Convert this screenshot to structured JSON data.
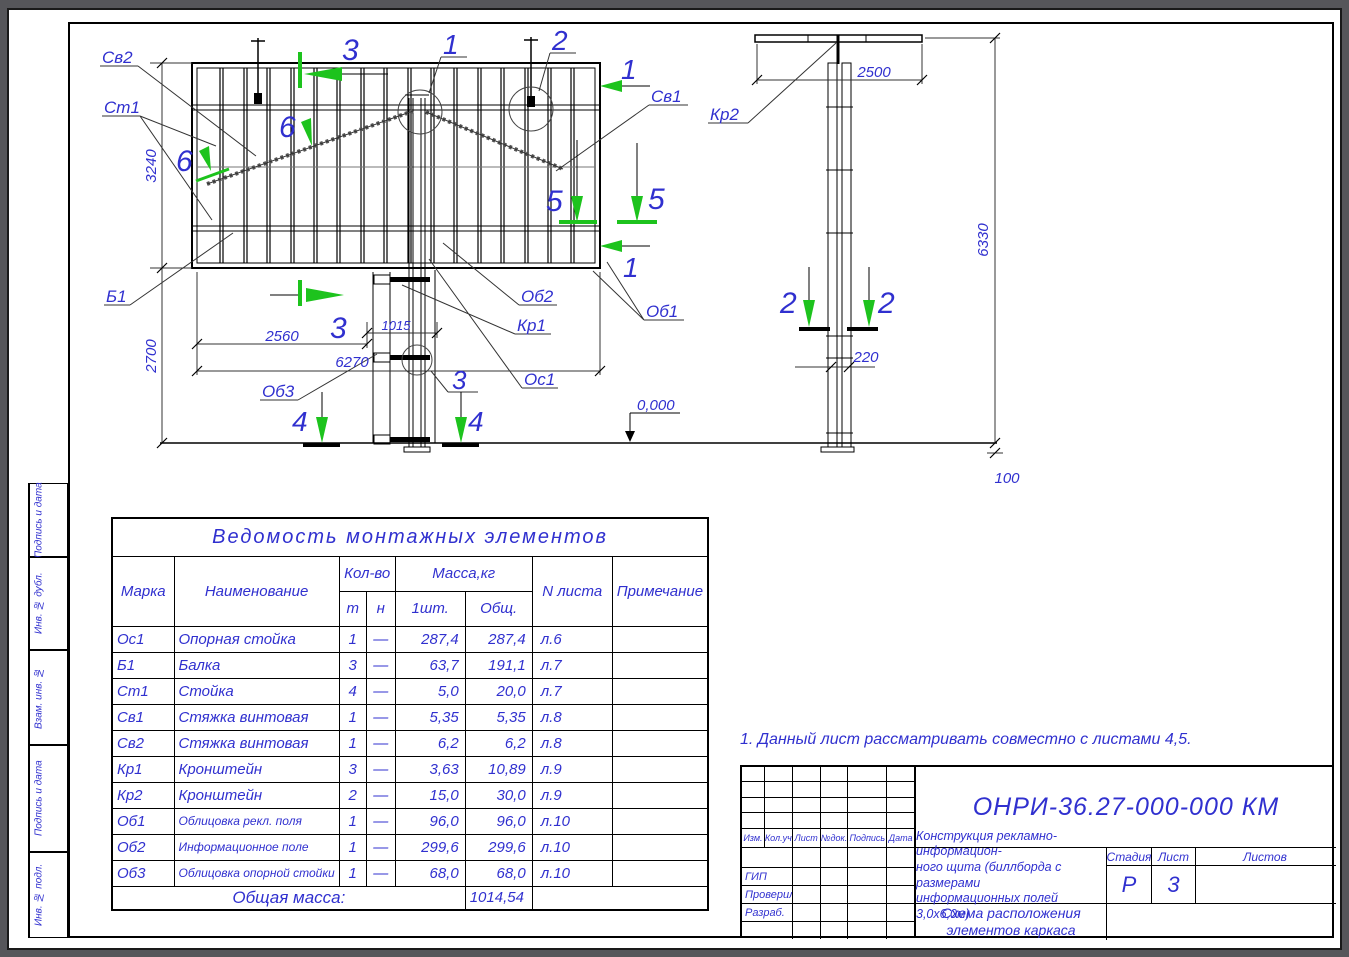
{
  "colors": {
    "blue": "#3030cf",
    "green": "#1dc31d",
    "line": "#000000",
    "background": "#56565a"
  },
  "sidebar": {
    "cells": [
      "Подпись и дата",
      "Инв. № дубл.",
      "Взам. инв. №",
      "Подпись и дата",
      "Инв. № подл."
    ]
  },
  "table": {
    "title": "Ведомость монтажных элементов",
    "col_mark": "Марка",
    "col_name": "Наименование",
    "col_qty": "Кол-во",
    "col_t": "т",
    "col_n": "н",
    "col_mass": "Масса,кг",
    "col_one": "1шт.",
    "col_total": "Общ.",
    "col_sheet": "N листа",
    "col_note": "Примечание",
    "rows": [
      {
        "mark": "Ос1",
        "name": "Опорная стойка",
        "t": "1",
        "n": "—",
        "one": "287,4",
        "total": "287,4",
        "sheet": "л.6",
        "note": ""
      },
      {
        "mark": "Б1",
        "name": "Балка",
        "t": "3",
        "n": "—",
        "one": "63,7",
        "total": "191,1",
        "sheet": "л.7",
        "note": ""
      },
      {
        "mark": "Ст1",
        "name": "Стойка",
        "t": "4",
        "n": "—",
        "one": "5,0",
        "total": "20,0",
        "sheet": "л.7",
        "note": ""
      },
      {
        "mark": "Св1",
        "name": "Стяжка винтовая",
        "t": "1",
        "n": "—",
        "one": "5,35",
        "total": "5,35",
        "sheet": "л.8",
        "note": ""
      },
      {
        "mark": "Св2",
        "name": "Стяжка винтовая",
        "t": "1",
        "n": "—",
        "one": "6,2",
        "total": "6,2",
        "sheet": "л.8",
        "note": ""
      },
      {
        "mark": "Кр1",
        "name": "Кронштейн",
        "t": "3",
        "n": "—",
        "one": "3,63",
        "total": "10,89",
        "sheet": "л.9",
        "note": ""
      },
      {
        "mark": "Кр2",
        "name": "Кронштейн",
        "t": "2",
        "n": "—",
        "one": "15,0",
        "total": "30,0",
        "sheet": "л.9",
        "note": ""
      },
      {
        "mark": "Об1",
        "name": "Облицовка рекл. поля",
        "t": "1",
        "n": "—",
        "one": "96,0",
        "total": "96,0",
        "sheet": "л.10",
        "note": ""
      },
      {
        "mark": "Об2",
        "name": "Информационное поле",
        "t": "1",
        "n": "—",
        "one": "299,6",
        "total": "299,6",
        "sheet": "л.10",
        "note": ""
      },
      {
        "mark": "Об3",
        "name": "Облицовка опорной стойки",
        "t": "1",
        "n": "—",
        "one": "68,0",
        "total": "68,0",
        "sheet": "л.10",
        "note": ""
      }
    ],
    "total_label": "Общая масса:",
    "total_value": "1014,54"
  },
  "note": "1. Данный лист рассматривать совместно  с листами 4,5.",
  "stamp": {
    "designation": "ОНРИ-36.27-000-000 КМ",
    "rev": [
      "Изм.",
      "Кол.уч",
      "Лист",
      "№док.",
      "Подпись",
      "Дата"
    ],
    "roles": [
      "ГИП",
      "Проверил",
      "Разраб."
    ],
    "doc1": "Конструкция рекламно-информацион-",
    "doc2": "ного щита (биллборда с размерами",
    "doc3": "информационных полей 3,0х6,0м)",
    "scheme1": "Схема расположения",
    "scheme2": "элементов каркаса",
    "stage_label": "Стадия",
    "sheet_label": "Лист",
    "sheets_label": "Листов",
    "stage": "Р",
    "sheet_no": "3",
    "sheets_total": ""
  },
  "drawing": {
    "labels": {
      "sv2": "Св2",
      "st1": "Ст1",
      "b1": "Б1",
      "sv1": "Св1",
      "ob1": "Об1",
      "ob2": "Об2",
      "ob3": "Об3",
      "kr1": "Кр1",
      "kr2": "Кр2",
      "os1": "Ос1"
    },
    "marks": {
      "m1": "1",
      "m2": "2",
      "m3": "3",
      "m4": "4",
      "m5": "5",
      "m6": "6"
    },
    "dims": {
      "d3240": "3240",
      "d2700": "2700",
      "d2560": "2560",
      "d1015": "1015",
      "d6270": "6270",
      "d2500": "2500",
      "d6330": "6330",
      "d220": "220",
      "d100": "100",
      "level": "0,000"
    }
  }
}
